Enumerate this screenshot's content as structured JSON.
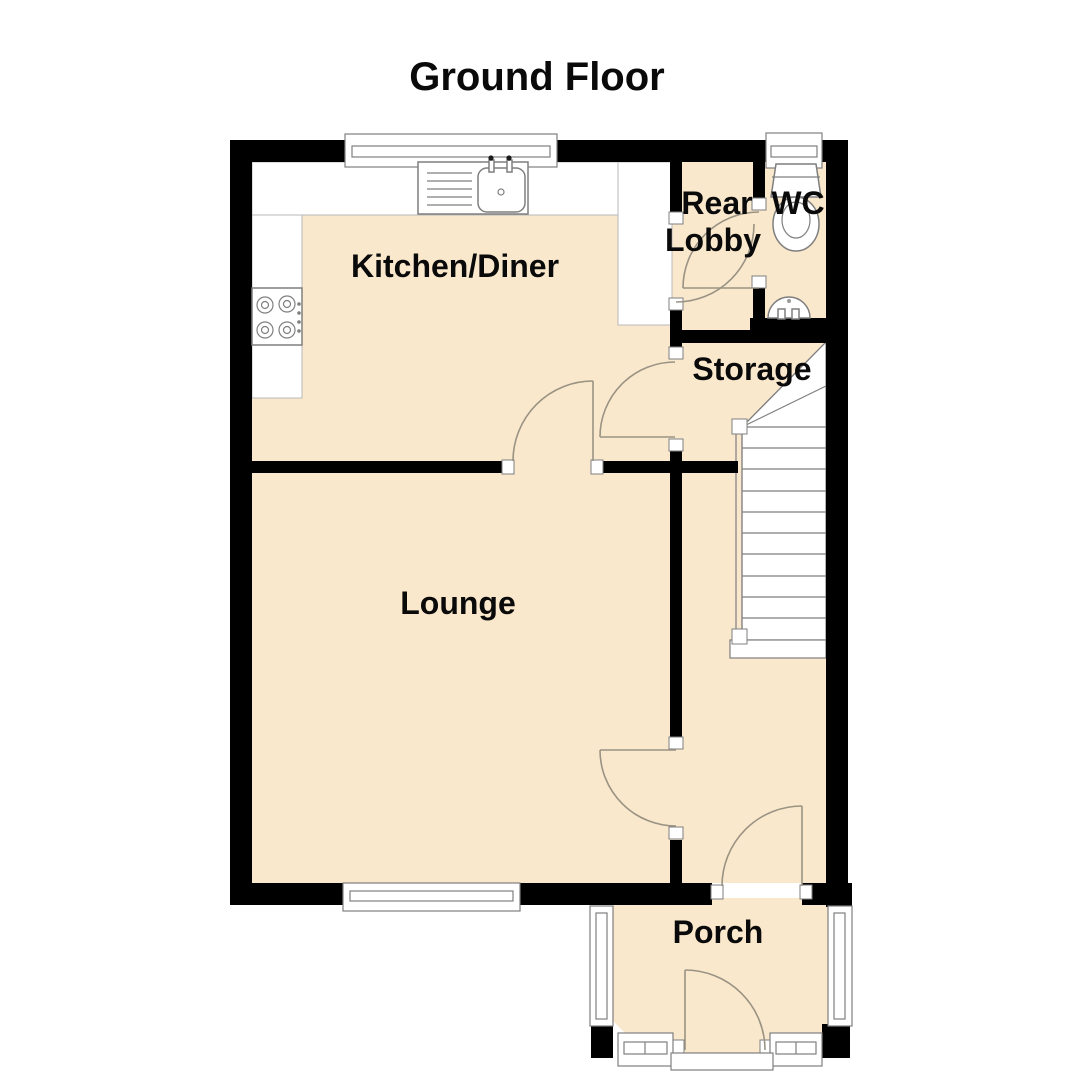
{
  "title": "Ground Floor",
  "colors": {
    "floor": "#fae8cc",
    "wall": "#000000",
    "outline": "#7f7f7f"
  },
  "rooms": {
    "kitchen": {
      "label": "Kitchen/Diner"
    },
    "rear_lobby": {
      "label_line1": "Rear",
      "label_line2": "Lobby"
    },
    "wc": {
      "label": "WC"
    },
    "storage": {
      "label": "Storage"
    },
    "lounge": {
      "label": "Lounge"
    },
    "porch": {
      "label": "Porch"
    }
  },
  "fixtures": {
    "sink": "kitchen-sink",
    "hob": "hob",
    "toilet": "toilet",
    "basin": "wash-basin",
    "stairs": "staircase"
  }
}
